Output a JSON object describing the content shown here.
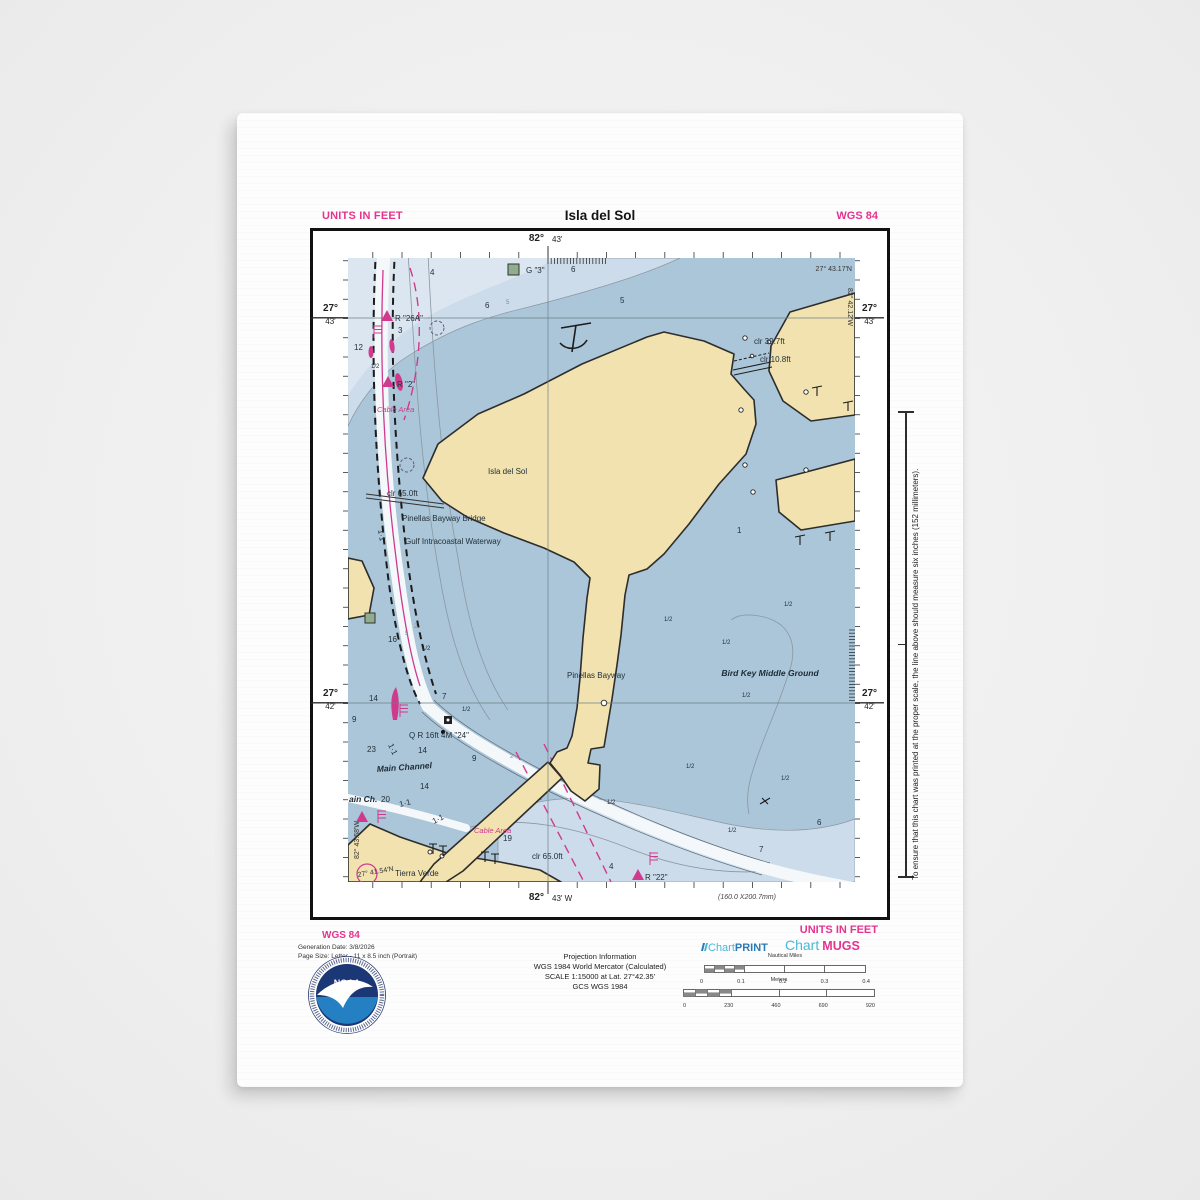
{
  "header": {
    "units_left": "UNITS IN FEET",
    "title": "Isla del Sol",
    "datum_right": "WGS 84"
  },
  "margin": {
    "top_deg": "82°",
    "top_min": "43'",
    "bottom_deg": "82°",
    "bottom_min": "43' W",
    "lat_top_deg": "27°",
    "lat_top_min": "43'",
    "lat_bottom_deg": "27°",
    "lat_bottom_min": "42'",
    "print_size": "(160.0 X200.7mm)"
  },
  "map": {
    "labels": [
      {
        "t": "G \"3\"",
        "x": 178,
        "y": 15
      },
      {
        "t": "27° 43.17'N",
        "x": 504,
        "y": 13,
        "c": "c",
        "a": "e"
      },
      {
        "t": "82° 42.12'W",
        "x": 500,
        "y": 30,
        "c": "c",
        "r": 90
      },
      {
        "t": "clr 39.7ft",
        "x": 406,
        "y": 86
      },
      {
        "t": "clr 10.8ft",
        "x": 412,
        "y": 104
      },
      {
        "t": "R \"26A\"",
        "x": 47,
        "y": 63
      },
      {
        "t": "R \"2\"",
        "x": 49,
        "y": 129
      },
      {
        "t": "Cable Area",
        "x": 29,
        "y": 154,
        "c": "m"
      },
      {
        "t": "Isla del Sol",
        "x": 140,
        "y": 216,
        "s": 9.5
      },
      {
        "t": "clr 65.0ft",
        "x": 39,
        "y": 238
      },
      {
        "t": "Pinellas Bayway Bridge",
        "x": 54,
        "y": 263
      },
      {
        "t": "Gulf Intracoastal Waterway",
        "x": 57,
        "y": 286
      },
      {
        "t": "Pinellas Bayway",
        "x": 219,
        "y": 420
      },
      {
        "t": "Bird Key Middle Ground",
        "x": 422,
        "y": 418,
        "c": "bi",
        "a": "m"
      },
      {
        "t": "Q R 16ft 4M \"24\"",
        "x": 61,
        "y": 480
      },
      {
        "t": "Main Channel",
        "x": 29,
        "y": 514,
        "c": "bi",
        "r": -4
      },
      {
        "t": "ain Ch.",
        "x": 1,
        "y": 544,
        "c": "bi",
        "s": 8
      },
      {
        "t": "Cable Area",
        "x": 126,
        "y": 575,
        "c": "m"
      },
      {
        "t": "Tierra Verde",
        "x": 47,
        "y": 618,
        "s": 9.5
      },
      {
        "t": "clr 65.0ft",
        "x": 184,
        "y": 601
      },
      {
        "t": "R \"22\"",
        "x": 297,
        "y": 622
      },
      {
        "t": "27° 41.54'N",
        "x": 10,
        "y": 619,
        "c": "c",
        "r": -10
      },
      {
        "t": "82° 43.58'W",
        "x": 11,
        "y": 601,
        "c": "c",
        "r": -90
      },
      {
        "t": "1·1",
        "x": 30,
        "y": 272,
        "c": "n",
        "r": 80
      },
      {
        "t": "1·1",
        "x": 40,
        "y": 487,
        "c": "n",
        "r": 65
      },
      {
        "t": "1·1",
        "x": 52,
        "y": 549,
        "c": "n",
        "r": -14
      },
      {
        "t": "1·1",
        "x": 86,
        "y": 566,
        "c": "n",
        "r": -27
      },
      {
        "t": "5",
        "x": 158,
        "y": 46,
        "c": "w"
      },
      {
        "t": "5",
        "x": 57,
        "y": 377,
        "c": "w"
      },
      {
        "t": "2",
        "x": 66,
        "y": 370,
        "c": "w"
      },
      {
        "t": "2",
        "x": 162,
        "y": 500,
        "c": "w"
      }
    ],
    "depths": [
      [
        "4",
        82,
        17
      ],
      [
        "6",
        223,
        14
      ],
      [
        "6",
        137,
        50
      ],
      [
        "5",
        272,
        45
      ],
      [
        "3",
        50,
        75
      ],
      [
        "12",
        6,
        92
      ],
      [
        "16",
        40,
        384
      ],
      [
        "14",
        21,
        443
      ],
      [
        "7",
        94,
        441
      ],
      [
        "9",
        4,
        464
      ],
      [
        "23",
        19,
        494
      ],
      [
        "14",
        70,
        495
      ],
      [
        "9",
        124,
        503
      ],
      [
        "14",
        72,
        531
      ],
      [
        "20",
        33,
        544
      ],
      [
        "19",
        155,
        583
      ],
      [
        "1",
        389,
        275
      ],
      [
        "6",
        469,
        567
      ],
      [
        "7",
        411,
        594
      ],
      [
        "4",
        261,
        611
      ]
    ],
    "halves": [
      [
        23,
        110
      ],
      [
        74,
        392
      ],
      [
        114,
        453
      ],
      [
        316,
        363
      ],
      [
        436,
        348
      ],
      [
        374,
        386
      ],
      [
        394,
        439
      ],
      [
        338,
        510
      ],
      [
        433,
        522
      ],
      [
        259,
        546
      ],
      [
        380,
        574
      ]
    ]
  },
  "side_note": "To ensure that this chart was printed at the proper scale, the line above should measure six inches (152 millimeters).",
  "footer": {
    "datum": "WGS 84",
    "generation_date": "Generation Date: 3/8/2026",
    "page_size": "Page Size: Letter - 11 x 8.5 inch (Portrait)",
    "noaa_label": "NOAA",
    "projection_lines": [
      "Projection Information",
      "WGS 1984 World Mercator (Calculated)",
      "SCALE 1:15000 at Lat. 27°42.35'",
      "GCS WGS 1984"
    ],
    "brand_print_a": "Chart",
    "brand_print_b": "PRINT",
    "brand_mugs_a": "Chart",
    "brand_mugs_b": "MUGS",
    "units_right": "UNITS IN FEET",
    "scalebars": [
      {
        "label": "Nautical Miles",
        "ticks": [
          "0",
          "0.1",
          "0.2",
          "0.3",
          "0.4"
        ]
      },
      {
        "label": "Meters",
        "ticks": [
          "0",
          "230",
          "460",
          "690",
          "920"
        ]
      }
    ]
  },
  "colors": {
    "accent_pink": "#e6338f",
    "map_magenta": "#cf3a8e",
    "water": "#abc6d8",
    "shallow": "#ccdcea",
    "land": "#f1e2af",
    "brand_cyan": "#49b8d8",
    "brand_blue": "#2a7ab5",
    "noaa_navy": "#1c3775",
    "noaa_blue": "#2580c3"
  }
}
